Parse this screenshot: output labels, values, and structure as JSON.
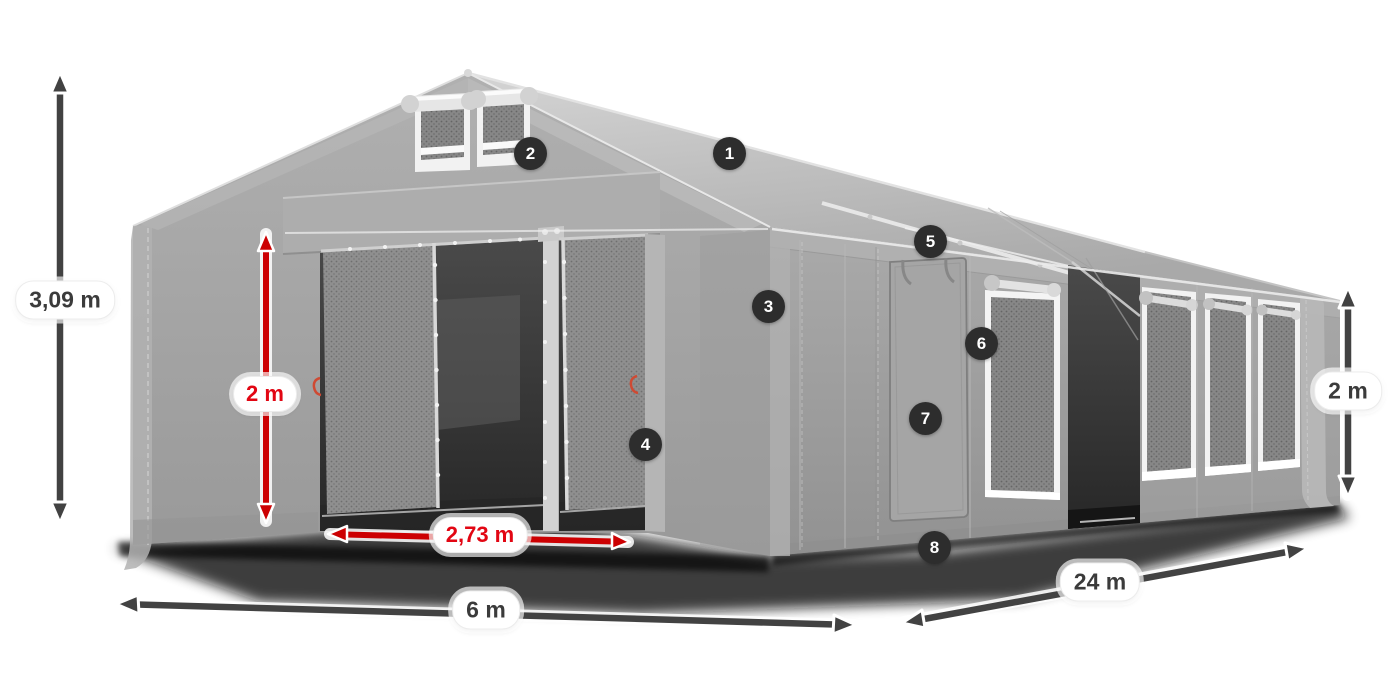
{
  "diagram": {
    "type": "product-dimension-diagram",
    "subject": "gray modular storage tent with open front doors, side door, mesh windows and dimension arrows",
    "feature_markers": [
      {
        "number": "1"
      },
      {
        "number": "2"
      },
      {
        "number": "3"
      },
      {
        "number": "4"
      },
      {
        "number": "5"
      },
      {
        "number": "6"
      },
      {
        "number": "7"
      },
      {
        "number": "8"
      }
    ],
    "dimensions": {
      "total_height": "3,09 m",
      "entrance_height": "2 m",
      "entrance_width": "2,73 m",
      "width": "6 m",
      "length": "24 m",
      "side_wall_height": "2 m"
    },
    "colors": {
      "dimension_red_arrow": "#cc0002",
      "dimension_red_text": "#e20613",
      "dimension_dark": "#424242",
      "marker_background": "#2d2d2d",
      "tent_gray": "#a6a6a6",
      "background": "#ffffff"
    }
  }
}
